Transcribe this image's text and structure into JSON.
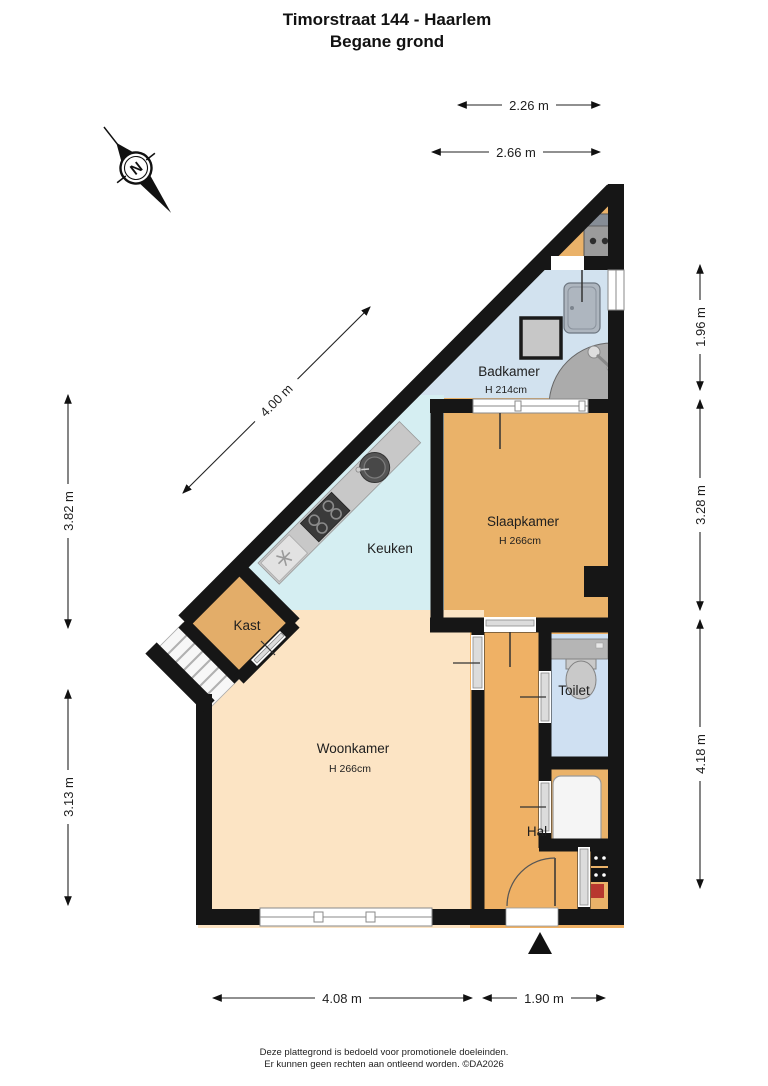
{
  "title": {
    "line1": "Timorstraat 144 - Haarlem",
    "line2": "Begane grond"
  },
  "compass": {
    "north_label": "N"
  },
  "rooms": {
    "badkamer": {
      "name": "Badkamer",
      "ceiling_height": "H 214cm"
    },
    "slaapkamer": {
      "name": "Slaapkamer",
      "ceiling_height": "H 266cm"
    },
    "keuken": {
      "name": "Keuken"
    },
    "kast": {
      "name": "Kast"
    },
    "woonkamer": {
      "name": "Woonkamer",
      "ceiling_height": "H 266cm"
    },
    "toilet": {
      "name": "Toilet"
    },
    "hal": {
      "name": "Hal"
    }
  },
  "dimensions": {
    "top_inner": "2.26 m",
    "top_outer": "2.66 m",
    "left_upper": "3.82 m",
    "left_lower": "3.13 m",
    "right_top": "1.96 m",
    "right_middle": "3.28 m",
    "right_bottom": "4.18 m",
    "bottom_left": "4.08 m",
    "bottom_right": "1.90 m",
    "diagonal": "4.00 m"
  },
  "footer": {
    "line1": "Deze plattegrond is bedoeld voor promotionele doeleinden.",
    "line2": "Er kunnen geen rechten aan ontleend worden. ©DA2026"
  },
  "colors": {
    "wall": "#161616",
    "bedroom_floor": "#eab269",
    "hall_floor": "#efb165",
    "livingroom_floor": "#fce4c4",
    "kitchen_floor": "#d5eef2",
    "bathroom_floor": "#d2e2ef",
    "toilet_floor": "#cfe0f2",
    "closet_floor": "#e3ad69",
    "counter_gray": "#c8c8c8",
    "panel_red": "#b8372f"
  }
}
